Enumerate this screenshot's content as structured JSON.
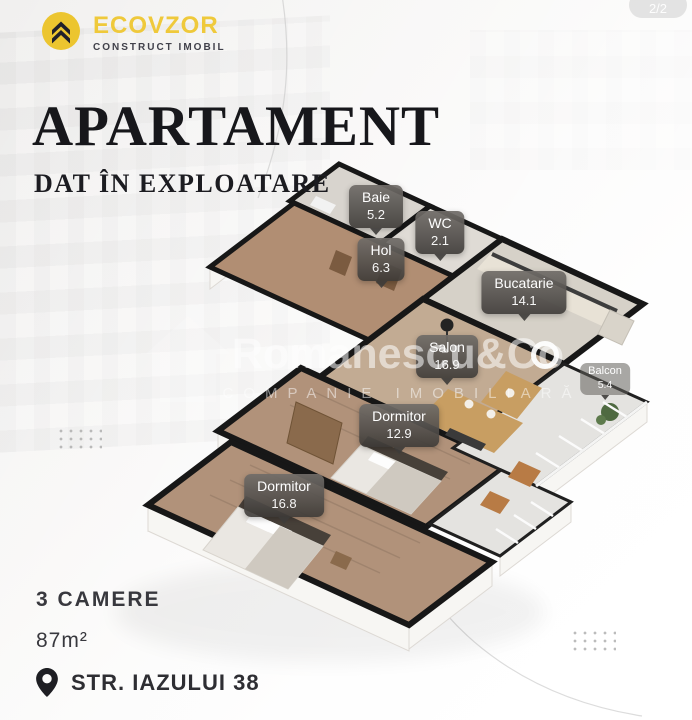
{
  "pager": "2/2",
  "logo": {
    "name": "ECOVZOR",
    "tagline": "CONSTRUCT IMOBIL",
    "icon": "double-chevron-up-icon",
    "circle_color": "#ECC52F",
    "name_color": "#EFC93B"
  },
  "header": {
    "title": "APARTAMENT",
    "subtitle": "DAT ÎN EXPLOATARE"
  },
  "floorplan": {
    "rooms": [
      {
        "id": "baie",
        "label": "Baie",
        "area": "5.2"
      },
      {
        "id": "wc",
        "label": "WC",
        "area": "2.1"
      },
      {
        "id": "hol",
        "label": "Hol",
        "area": "6.3"
      },
      {
        "id": "bucatarie",
        "label": "Bucatarie",
        "area": "14.1"
      },
      {
        "id": "salon",
        "label": "Salon",
        "area": "16.9"
      },
      {
        "id": "dormitor-mic",
        "label": "Dormitor",
        "area": "12.9"
      },
      {
        "id": "dormitor-mare",
        "label": "Dormitor",
        "area": "16.8"
      },
      {
        "id": "balcon",
        "label": "Balcon",
        "area": "5.4"
      }
    ],
    "wall_color": "#171717"
  },
  "watermark": {
    "brand": "Romanescu&Co",
    "tagline": "COMPANIE IMOBILIARĂ"
  },
  "details": {
    "rooms": "3 CAMERE",
    "surface": "87m²",
    "address": "STR. IAZULUI 38",
    "pin_icon": "location-pin-icon"
  }
}
